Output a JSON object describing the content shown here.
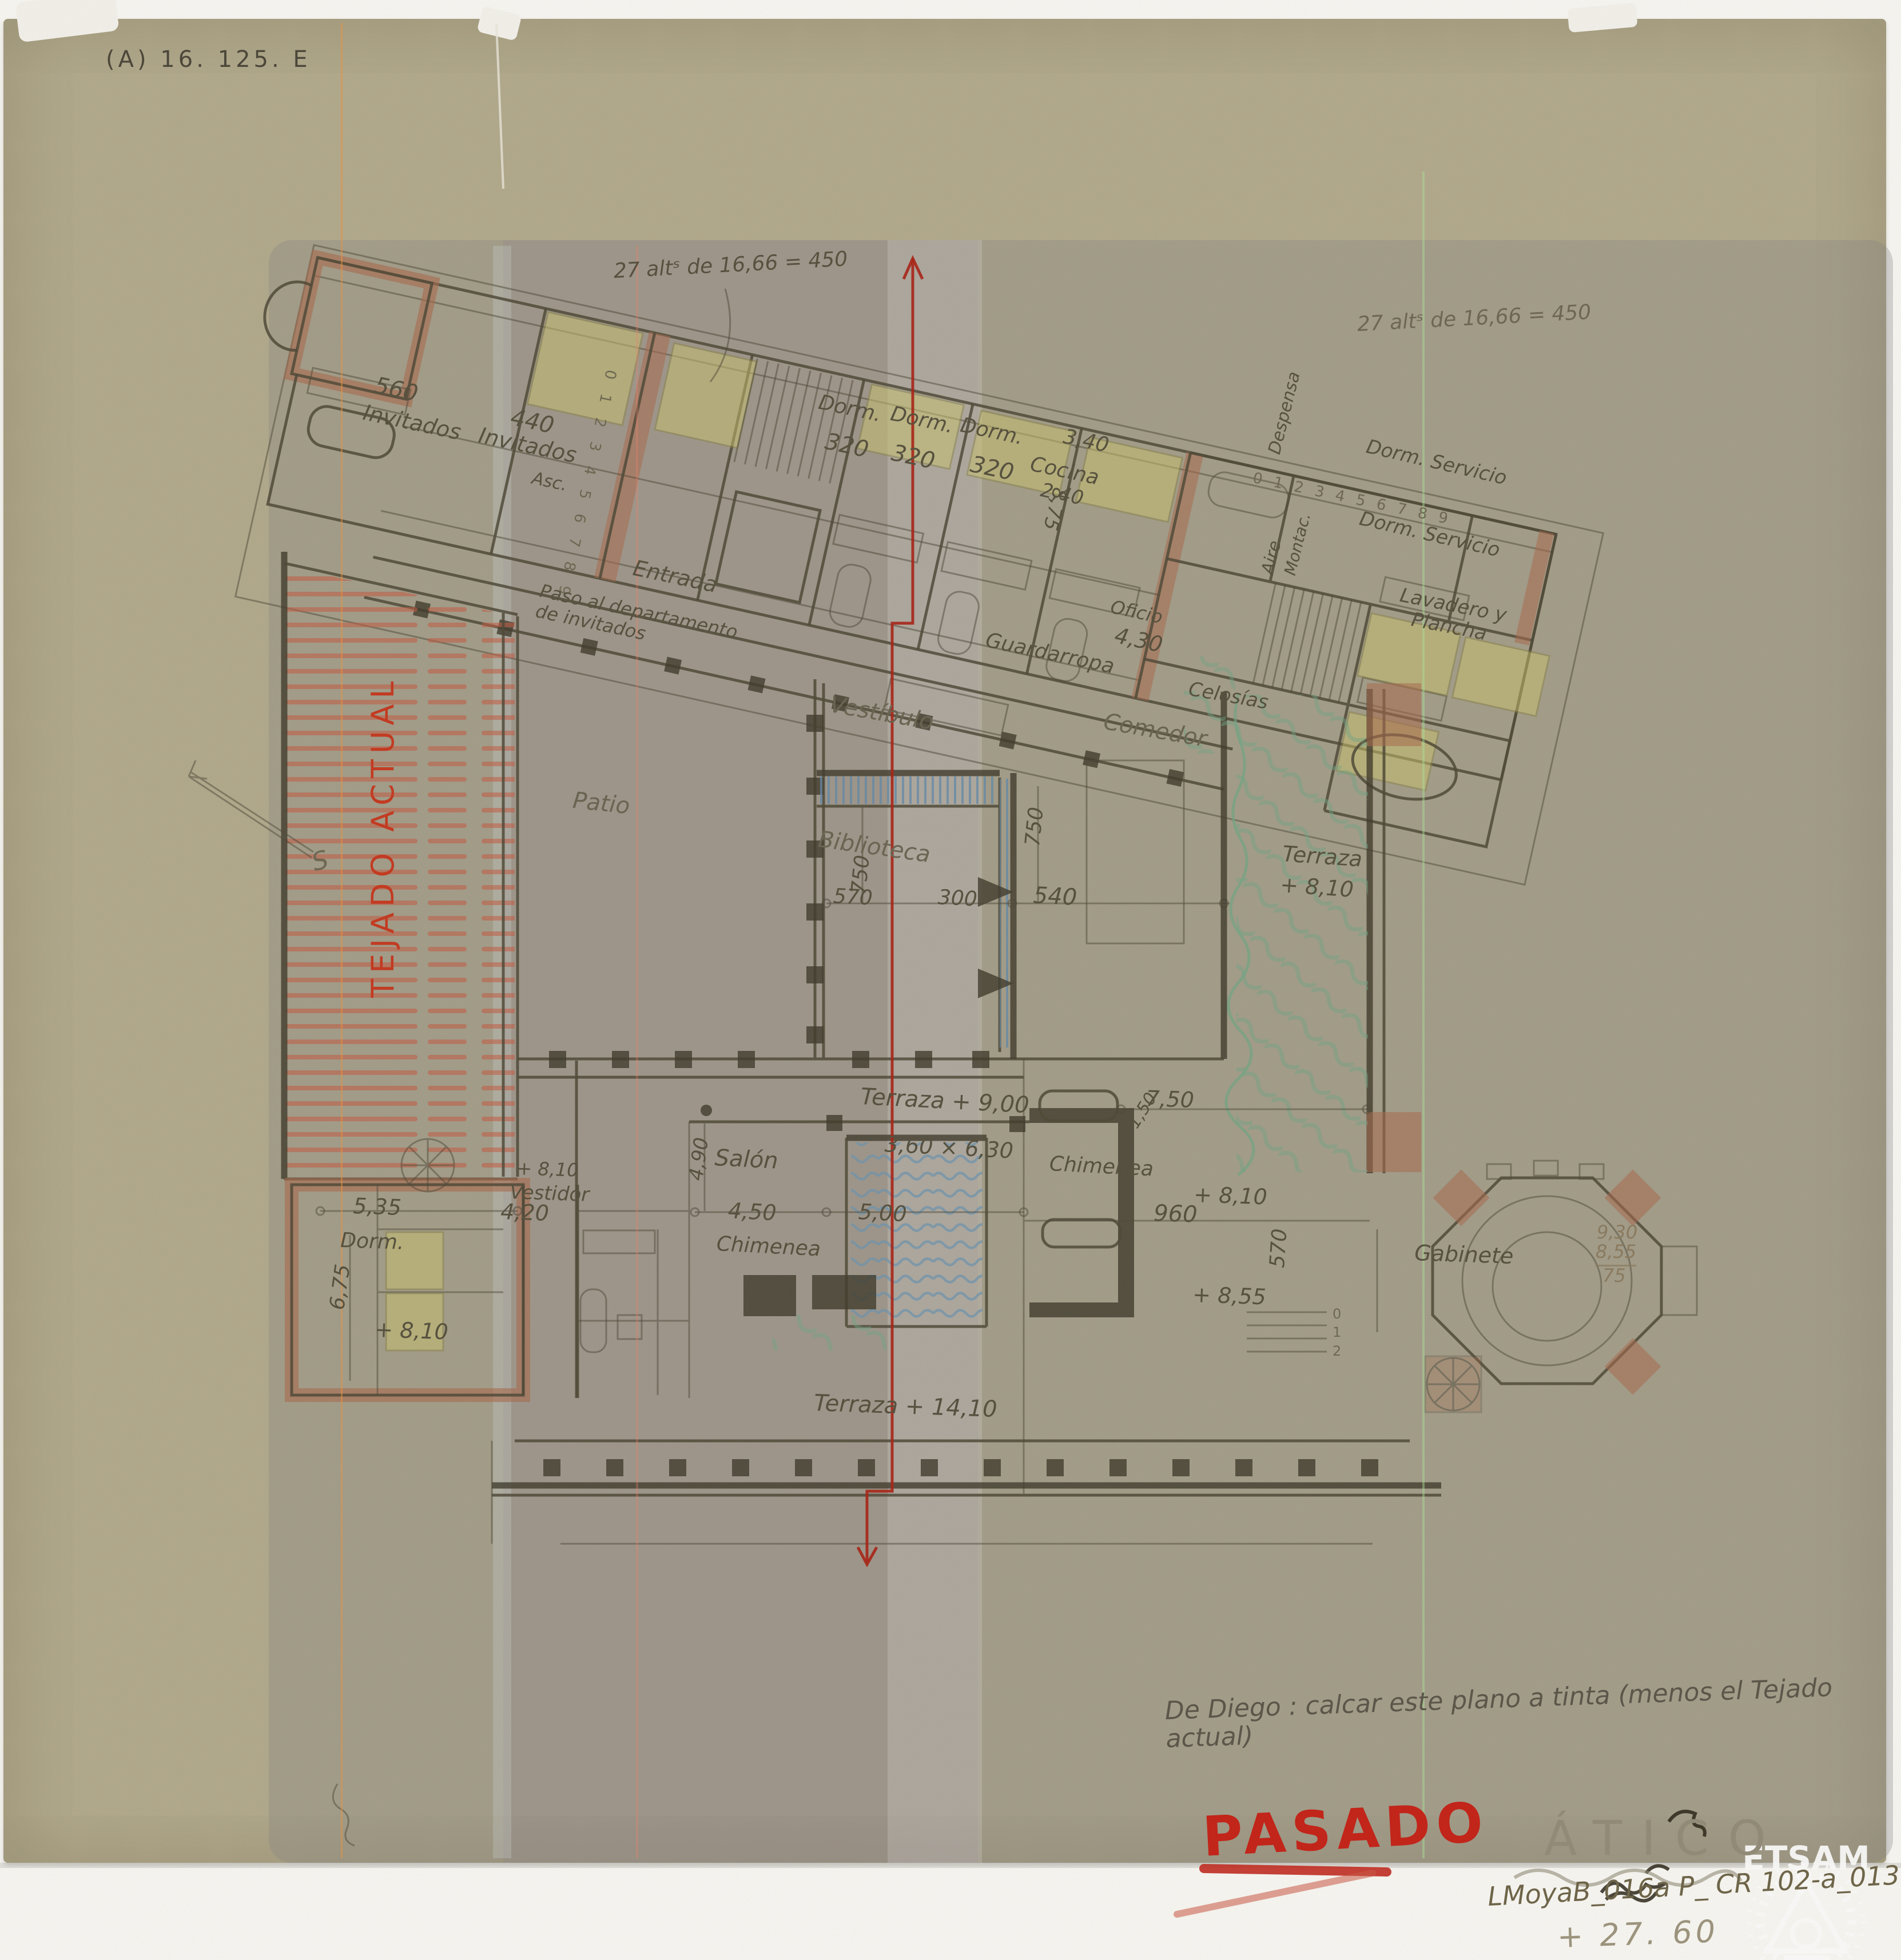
{
  "document": {
    "type": "Hand-drawn attic floor plan on tracing paper (pencil and crayon)",
    "archive_code": "(A) 16. 125. E",
    "reference_code": "LMoyaB_016a P_ CR 102-a_013",
    "stamp_text": "ETSAM",
    "status_stamp": "PASADO",
    "sheet_title": "ÁTICO",
    "sheet_level": "+ 27. 60"
  },
  "palette": {
    "paper_tan": "#b2a98b",
    "paper_gray_overlay": "#7d7d80",
    "graphite": "#57513f",
    "wall_olive": "#4a4433",
    "terracotta": "#a9674a",
    "bed_yellow": "#cdc56c",
    "hatch_blue": "#5e87a8",
    "hatch_green": "#6fa583",
    "roof_hatch_red": "#c4573d",
    "marker_red": "#c2251a"
  },
  "labels": {
    "archive_code": "(A) 16. 125. E",
    "note_mid": "27 altˢ de 16,66 = 450",
    "note_tr": "27 altˢ de 16,66 = 450",
    "dim_560": "560",
    "invitados_a": "Invitados",
    "dim_440": "440",
    "invitados_b": "Invitados",
    "asc": "Asc.",
    "stairs_a": "0 1 2 3 4 5 6 7 8 9",
    "dorm_a": "Dorm.",
    "dim_320a": "320",
    "dorm_b": "Dorm.",
    "dim_320b": "320",
    "dorm_c": "Dorm.",
    "dim_320c": "320",
    "dim_340": "3,40",
    "cocina": "Cocina",
    "dim_240": "2,40",
    "dim_875": "8,75",
    "despensa": "Despensa",
    "aire": "Aire",
    "montac": "Montac.",
    "stairs_b": "0 1 2 3 4 5 6 7 8 9",
    "dorm_serv_a": "Dorm. Servicio",
    "dorm_serv_b": "Dorm. Servicio",
    "lavadero": "Lavadero y\nPlancha",
    "entrada": "Entrada",
    "paso": "Paso al departamento\nde invitados",
    "guardarropa": "Guardarropa",
    "oficio": "Oficio",
    "dim_430": "4,30",
    "vestibulo": "Vestíbulo",
    "biblioteca": "Biblioteca",
    "dim_750a": "750",
    "dim_570": "570",
    "dim_300": "300",
    "dim_540": "540",
    "dim_750b": "750",
    "comedor": "Comedor",
    "celosias": "Celosías",
    "patio": "Patio",
    "tejado_actual": "TEJADO ACTUAL",
    "terraza_e1": "Terraza",
    "terraza_e2": "+ 8,10",
    "terraza_p": "Terraza + 9,00",
    "pool_dim": "3,60 × 6,30",
    "dim_500": "5,00",
    "dim_450": "4,50",
    "salon": "Salón",
    "dim_490": "4,90",
    "chimenea_a": "Chimenea",
    "chimenea_b": "Chimenea",
    "dim_150": "1,50",
    "dim_750c": "7,50",
    "plus810_estar": "+ 8,10",
    "dim_960": "960",
    "dim_570b": "570",
    "plus855": "+ 8,55",
    "steps_012": "0\n1\n2",
    "vestidor": "Vestidor",
    "dim_420": "4,20",
    "plus810_vest": "+ 8,10",
    "dim_535": "5,35",
    "dorm_sw": "Dorm.",
    "dim_675": "6,75",
    "plus810_dorm": "+ 8,10",
    "gabinete": "Gabinete",
    "calc_930": "9,30",
    "calc_855": "8,55",
    "calc_75": "75",
    "terraza_s": "Terraza + 14,10",
    "instruction": "De Diego : calcar este plano a tinta (menos el Tejado actual)",
    "pasado": "PASADO",
    "atico": "ÁTICO",
    "level_2760": "+ 27. 60",
    "reference": "LMoyaB_016a P_ CR 102-a_013",
    "etsam": "ETSAM",
    "north_s": "S"
  }
}
